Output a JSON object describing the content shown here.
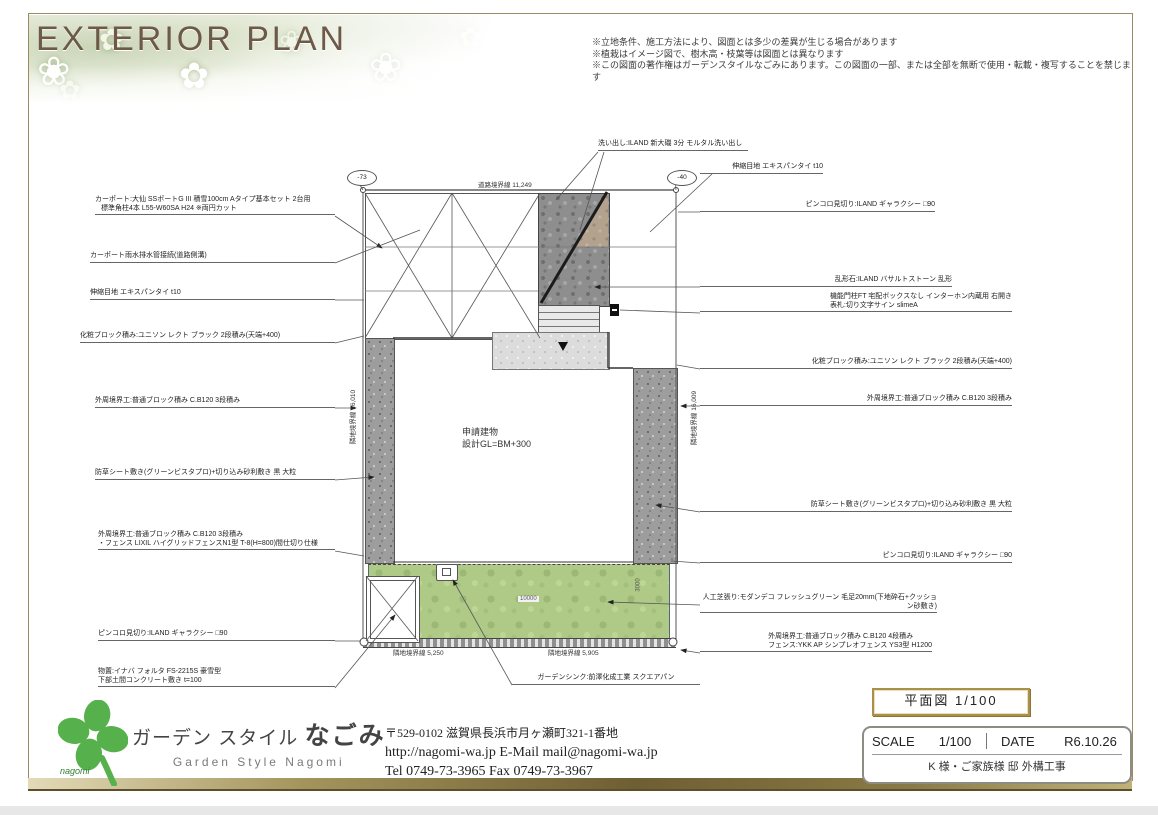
{
  "header": {
    "title": "EXTERIOR PLAN",
    "disclaimer": [
      "※立地条件、施工方法により、図面とは多少の差異が生じる場合があります",
      "※植栽はイメージ図で、樹木高・枝葉等は図面とは異なります",
      "※この図面の著作権はガーデンスタイルなごみにあります。この図面の一部、または全部を無断で使用・転載・複写することを禁じます"
    ]
  },
  "callouts": {
    "top_wash": "洗い出し:ILAND 新大磯 3分 モルタル洗い出し",
    "left": [
      {
        "t1": "カーポート:大仙 SSポートG III 積雪100cm Aタイプ基本セット 2台用",
        "t2": "標準角柱4本 L55-W60SA H24 ※両円カット"
      },
      {
        "t1": "カーポート雨水排水管接続(道路側溝)"
      },
      {
        "t1": "伸縮目地 エキスパンタイ t10"
      },
      {
        "t1": "化粧ブロック積み:ユニソン レクト ブラック 2段積み(天端+400)"
      },
      {
        "t1": "外周境界工:普通ブロック積み C.B120 3段積み"
      },
      {
        "t1": "防草シート敷き(グリーンビスタプロ)+切り込み砂利敷き 黒 大粒"
      },
      {
        "t1": "外周境界工:普通ブロック積み C.B120 3段積み",
        "t2": "・フェンス LIXIL ハイグリッドフェンスN1型 T-8(H=800)間仕切り仕様"
      },
      {
        "t1": "ピンコロ見切り:ILAND ギャラクシー □90"
      },
      {
        "t1": "物置:イナバ フォルタ FS-2215S 豪雪型",
        "t2": "下部土間コンクリート敷き t=100"
      }
    ],
    "right": [
      {
        "t1": "伸縮目地 エキスパンタイ t10"
      },
      {
        "t1": "ピンコロ見切り:ILAND ギャラクシー □90"
      },
      {
        "t1": "乱形石:ILAND バサルトストーン 乱形"
      },
      {
        "t1": "機能門柱FT 宅配ボックスなし インターホン内蔵用 右開き",
        "t2": "表札:切り文字サイン slimeA"
      },
      {
        "t1": "化粧ブロック積み:ユニソン レクト ブラック 2段積み(天端+400)"
      },
      {
        "t1": "外周境界工:普通ブロック積み C.B120 3段積み"
      },
      {
        "t1": "防草シート敷き(グリーンビスタプロ)+切り込み砂利敷き 黒 大粒"
      },
      {
        "t1": "ピンコロ見切り:ILAND ギャラクシー □90"
      },
      {
        "t1": "人工芝張り:モダンデコ フレッシュグリーン 毛足20mm(下地砕石+クッション砂敷き)"
      },
      {
        "t1": "外周境界工:普通ブロック積み C.B120 4段積み",
        "t2": "フェンス:YKK AP シンプレオフェンス YS3型 H1200"
      }
    ],
    "sink": "ガーデンシンク:前澤化成工業 スクエアパン"
  },
  "plan": {
    "markers": {
      "left": "-73",
      "right": "-40"
    },
    "boundaries": {
      "road": "道路境界線 11,249",
      "left": "隣地境界線 16,010",
      "right": "隣地境界線 16,009",
      "bottom_left": "隣地境界線 5,250",
      "bottom_right": "隣地境界線 5,905"
    },
    "building": {
      "l1": "申請建物",
      "l2": "設計GL=BM+300"
    },
    "dims": {
      "turf_w": "10000",
      "turf_h": "3000"
    }
  },
  "footer": {
    "logo": {
      "jp1": "ガーデン スタイル ",
      "jp2": "なごみ",
      "en": "Garden  Style  Nagomi",
      "mark": "nagomi"
    },
    "address": {
      "line1": "〒529-0102 滋賀県長浜市月ヶ瀬町321-1番地",
      "line2": "http://nagomi-wa.jp    E-Mail  mail@nagomi-wa.jp",
      "line3": "Tel  0749-73-3965      Fax  0749-73-3967"
    },
    "titleblock": {
      "drawing": "平面図 1/100",
      "scale_label": "SCALE",
      "scale_value": "1/100",
      "date_label": "DATE",
      "date_value": "R6.10.26",
      "project": "K 様・ご家族様 邸 外構工事"
    }
  },
  "colors": {
    "accent_gold": "#8a7a45",
    "clover_green": "#56b04c",
    "turf_green": "#aeca86",
    "title_brown": "#6d5947"
  }
}
